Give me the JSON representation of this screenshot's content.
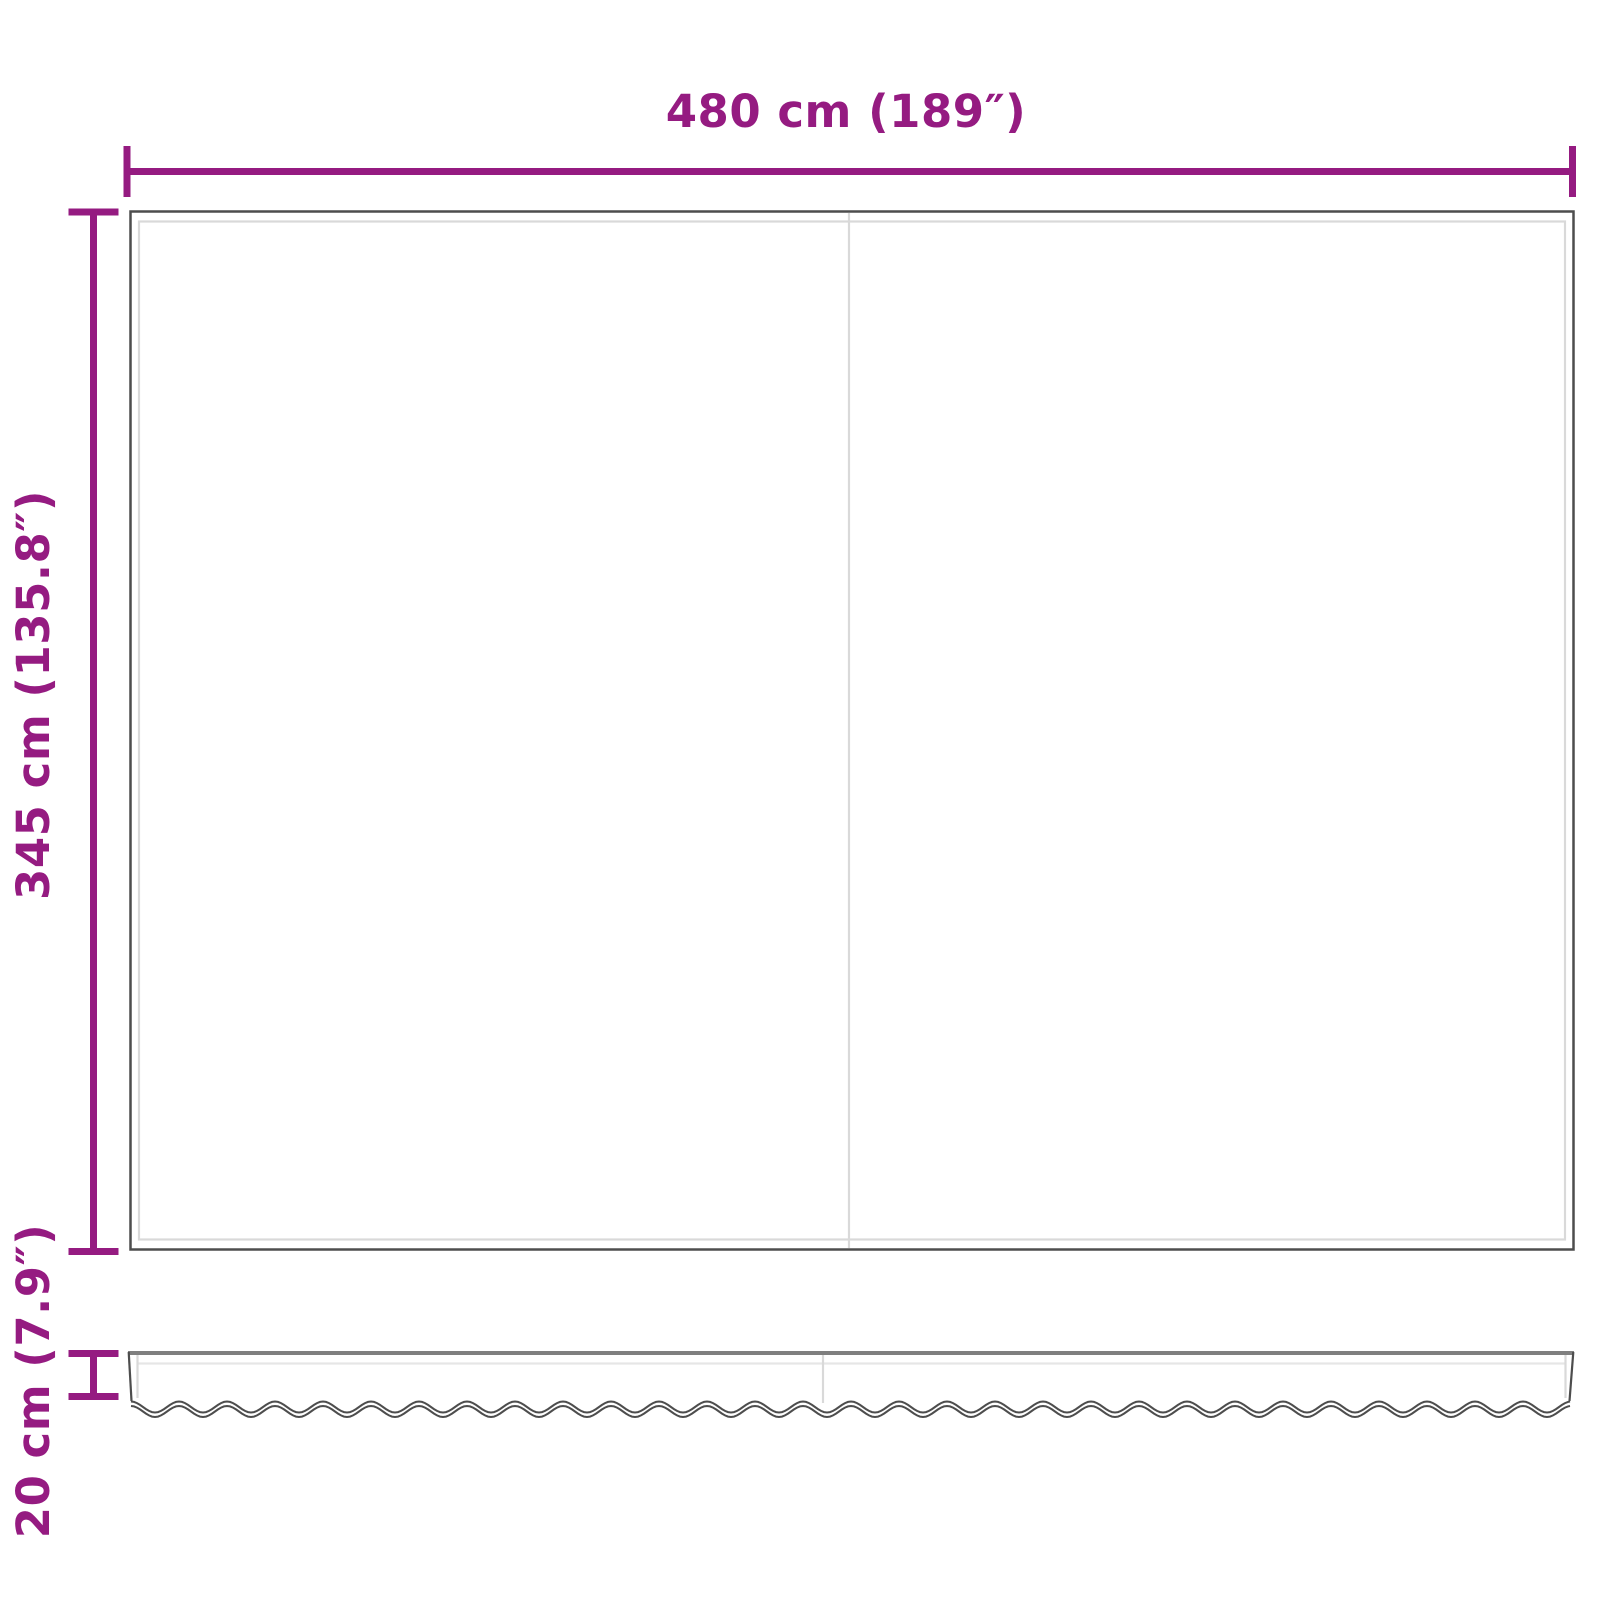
{
  "diagram": {
    "kind": "awning-fabric-dimension-drawing",
    "labels": {
      "width": "480 cm (189″)",
      "height": "345 cm (135.8″)",
      "valance_height": "20 cm (7.9″)"
    },
    "colors": {
      "dimension_lines": "#951b81",
      "panel_outline": "#4d4d4d",
      "seam_lines": "#d9d9d9",
      "seam_lines_light": "#e6e6e6",
      "valance_top_edge": "#7f7f7f",
      "background": "#ffffff"
    },
    "parts": {
      "main_panel": "fabric panel (top view)",
      "valance": "scalloped valance strip (front view)"
    }
  }
}
